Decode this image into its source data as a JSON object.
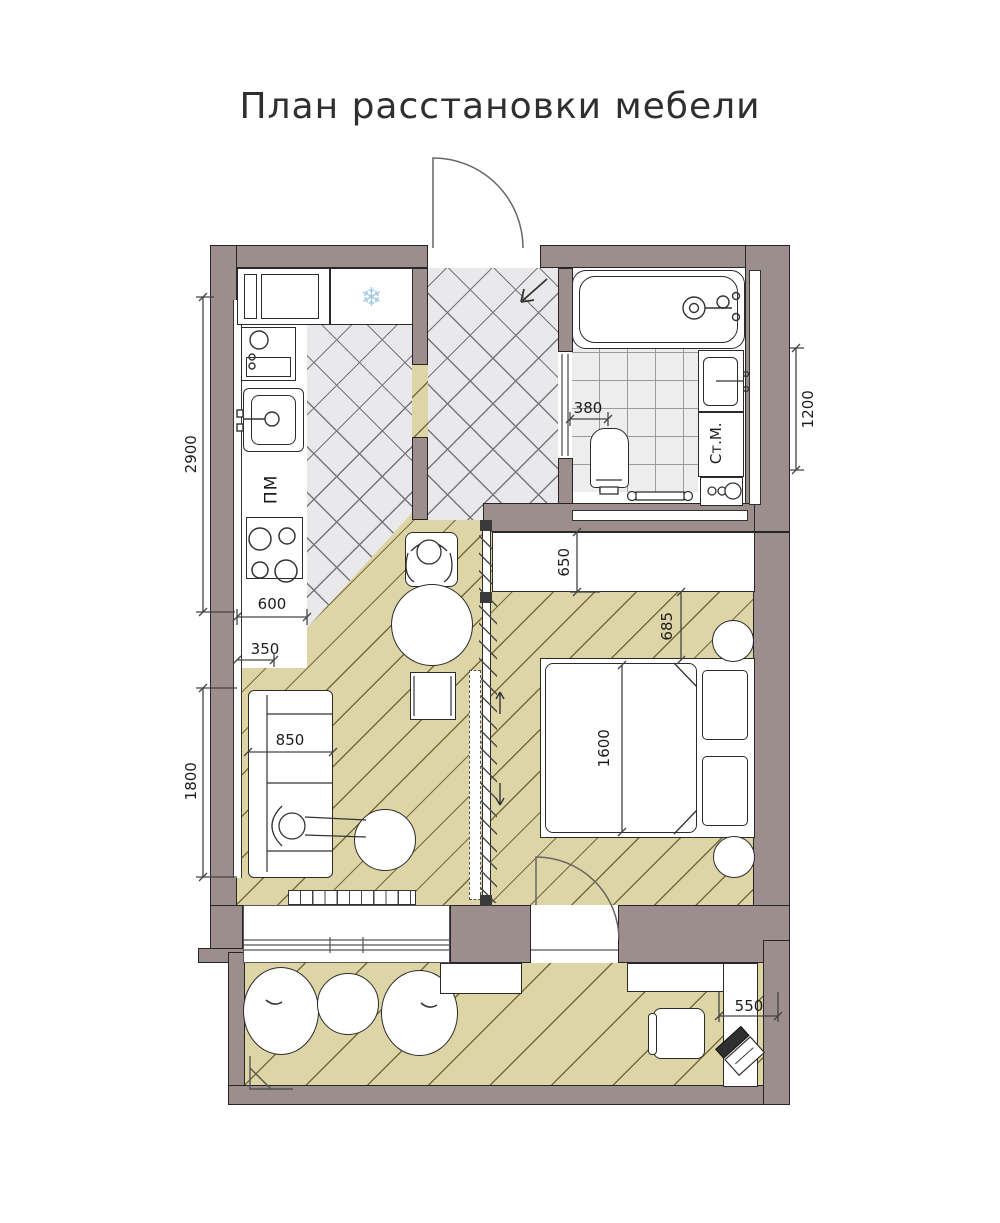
{
  "title": "План расстановки мебели",
  "labels": {
    "dishwasher": "ПМ",
    "washing_machine": "Ст.М."
  },
  "dims": {
    "kitchen_run": "2900",
    "counter_depth": "600",
    "counter_clearance": "350",
    "sofa_width": "850",
    "sofa_zone": "1800",
    "toilet_offset": "380",
    "bathroom_span": "1200",
    "wardrobe_depth": "650",
    "bed_clearance": "685",
    "bed_width": "1600",
    "desk_depth": "550"
  },
  "icons": {
    "fridge_snowflake": "❄"
  },
  "colors": {
    "wall": "#9d8e8e",
    "wood_floor": "#ded5a7",
    "tile_floor": "#e9e9eb",
    "bath_tile": "#ededee",
    "snowflake": "#a7cbe5"
  }
}
